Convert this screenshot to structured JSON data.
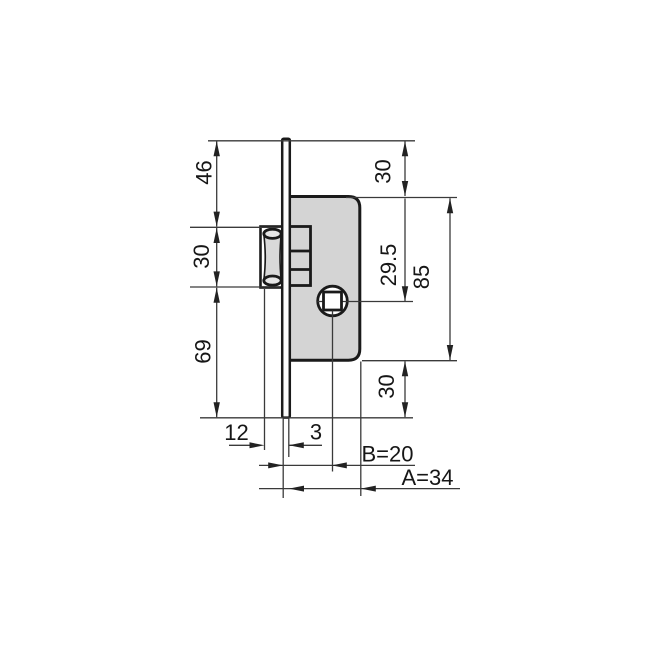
{
  "drawing": {
    "kind": "technical-dimension-drawing",
    "subject": "mortise lock case with roller latch, side elevation",
    "colors": {
      "background": "#ffffff",
      "outline": "#1a1a1a",
      "dimension_lines": "#3a3a3a",
      "case_fill": "#d4d4d4",
      "roller_fill": "#d9d9d9",
      "text": "#161616"
    },
    "labels": {
      "plate_top_to_latch": "46",
      "latch_height": "30",
      "latch_to_plate_bottom": "69",
      "plate_top_to_case_top": "30",
      "spindle_offset": "29.5",
      "case_height": "85",
      "case_bottom_to_plate_bottom": "30",
      "latch_projection": "12",
      "plate_thickness": "3",
      "backset": "B=20",
      "case_depth": "A=34"
    }
  }
}
